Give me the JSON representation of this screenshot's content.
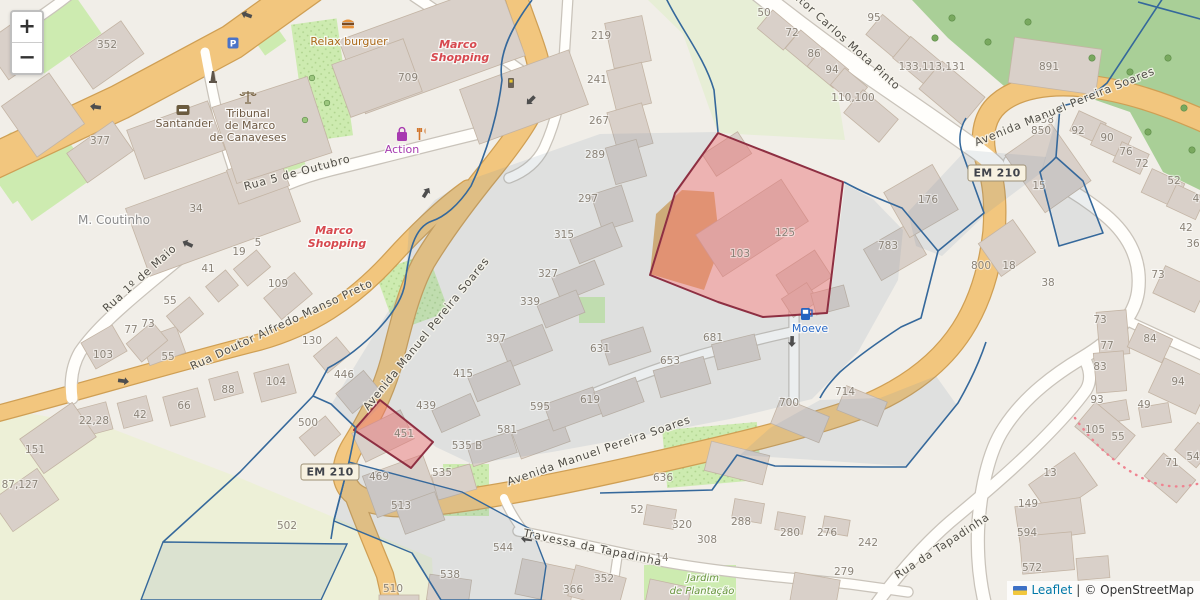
{
  "map_ui": {
    "zoom_control": {
      "zoom_in": "+",
      "zoom_out": "−"
    },
    "attribution": {
      "leaflet_link": "Leaflet",
      "separator": "|",
      "osm_credit": "© OpenStreetMap"
    },
    "road_ref_badges": [
      {
        "text": "EM 210",
        "x": 330,
        "y": 472
      },
      {
        "text": "EM 210",
        "x": 997,
        "y": 173
      }
    ]
  },
  "colors": {
    "boundary_line": "#35689b",
    "highlight_fill": "rgba(232,112,117,0.47)",
    "highlight_stroke": "#8e2f42",
    "road_major": "#f2c67e",
    "dotted_path": "#ef8390",
    "poi_mall": "#d7494f",
    "poi_shop": "#a73ab0",
    "poi_food": "#ab6a1a",
    "poi_fuel": "#2a6bc8",
    "poi_garden": "#68953d",
    "poi_amenity": "#6e5a44"
  },
  "street_labels": [
    {
      "text": "Rua 5 de Outubro",
      "x": 298,
      "y": 176,
      "rotation": -15
    },
    {
      "text": "Rua 1º de Maio",
      "x": 142,
      "y": 281,
      "rotation": -42
    },
    {
      "text": "Rua Doutor Alfredo Manso Preto",
      "x": 283,
      "y": 328,
      "rotation": -25
    },
    {
      "text": "Avenida Manuel Pereira Soares",
      "x": 429,
      "y": 336,
      "rotation": -51
    },
    {
      "text": "Avenida Manuel Pereira Soares",
      "x": 600,
      "y": 454,
      "rotation": -19
    },
    {
      "text": "Avenida Manuel Pereira Soares",
      "x": 1066,
      "y": 110,
      "rotation": -22
    },
    {
      "text": "Doutor Carlos Mota Pinto",
      "x": 838,
      "y": 38,
      "rotation": 42
    },
    {
      "text": "Travessa da Tapadinha",
      "x": 592,
      "y": 551,
      "rotation": 12
    },
    {
      "text": "Rua da Tapadinha",
      "x": 944,
      "y": 549,
      "rotation": -33
    }
  ],
  "poi_labels": [
    {
      "text": "Relax burguer",
      "x": 349,
      "y": 45,
      "kind": "poi-food"
    },
    {
      "text": "Marco",
      "x": 458,
      "y": 48,
      "kind": "poi-mall"
    },
    {
      "text": "Shopping",
      "x": 460,
      "y": 61,
      "kind": "poi-mall"
    },
    {
      "text": "Marco",
      "x": 334,
      "y": 234,
      "kind": "poi-mall"
    },
    {
      "text": "Shopping",
      "x": 337,
      "y": 247,
      "kind": "poi-mall"
    },
    {
      "text": "Action",
      "x": 402,
      "y": 153,
      "kind": "poi-shop"
    },
    {
      "text": "Santander",
      "x": 184,
      "y": 127,
      "kind": "poi-amenity"
    },
    {
      "text": "Tribunal",
      "x": 248,
      "y": 117,
      "kind": "poi-amenity"
    },
    {
      "text": "de Marco",
      "x": 250,
      "y": 129,
      "kind": "poi-amenity"
    },
    {
      "text": "de Canaveses",
      "x": 248,
      "y": 141,
      "kind": "poi-amenity"
    },
    {
      "text": "M. Coutinho",
      "x": 114,
      "y": 224,
      "kind": "poi-gray"
    },
    {
      "text": "Moeve",
      "x": 810,
      "y": 332,
      "kind": "poi-fuel"
    },
    {
      "text": "Jardim",
      "x": 703,
      "y": 581,
      "kind": "poi-garden"
    },
    {
      "text": "de Plantação",
      "x": 702,
      "y": 594,
      "kind": "poi-garden"
    }
  ],
  "house_numbers": [
    [
      107,
      48,
      "352"
    ],
    [
      100,
      144,
      "377"
    ],
    [
      408,
      81,
      "709"
    ],
    [
      196,
      212,
      "34"
    ],
    [
      258,
      246,
      "5"
    ],
    [
      239,
      255,
      "19"
    ],
    [
      208,
      272,
      "41"
    ],
    [
      278,
      287,
      "109"
    ],
    [
      170,
      304,
      "55"
    ],
    [
      148,
      327,
      "73"
    ],
    [
      131,
      333,
      "77"
    ],
    [
      312,
      344,
      "130"
    ],
    [
      103,
      358,
      "103"
    ],
    [
      168,
      360,
      "55"
    ],
    [
      344,
      378,
      "446"
    ],
    [
      276,
      385,
      "104"
    ],
    [
      228,
      393,
      "88"
    ],
    [
      184,
      409,
      "66"
    ],
    [
      140,
      418,
      "42"
    ],
    [
      94,
      424,
      "22,28"
    ],
    [
      35,
      453,
      "151"
    ],
    [
      20,
      488,
      "87,127"
    ],
    [
      308,
      426,
      "500"
    ],
    [
      287,
      529,
      "502"
    ],
    [
      393,
      592,
      "510"
    ],
    [
      601,
      39,
      "219"
    ],
    [
      597,
      83,
      "241"
    ],
    [
      599,
      124,
      "267"
    ],
    [
      595,
      158,
      "289"
    ],
    [
      588,
      202,
      "297"
    ],
    [
      564,
      238,
      "315"
    ],
    [
      548,
      277,
      "327"
    ],
    [
      530,
      305,
      "339"
    ],
    [
      496,
      342,
      "397"
    ],
    [
      463,
      377,
      "415"
    ],
    [
      426,
      409,
      "439"
    ],
    [
      404,
      437,
      "451"
    ],
    [
      379,
      480,
      "469"
    ],
    [
      401,
      509,
      "513"
    ],
    [
      442,
      476,
      "535"
    ],
    [
      467,
      449,
      "535 B"
    ],
    [
      507,
      433,
      "581"
    ],
    [
      540,
      410,
      "595"
    ],
    [
      590,
      403,
      "619"
    ],
    [
      503,
      551,
      "544"
    ],
    [
      450,
      578,
      "538"
    ],
    [
      600,
      352,
      "631"
    ],
    [
      670,
      364,
      "653"
    ],
    [
      713,
      341,
      "681"
    ],
    [
      789,
      406,
      "700"
    ],
    [
      845,
      395,
      "714"
    ],
    [
      663,
      481,
      "636"
    ],
    [
      637,
      513,
      "52"
    ],
    [
      682,
      528,
      "320"
    ],
    [
      707,
      543,
      "308"
    ],
    [
      741,
      525,
      "288"
    ],
    [
      790,
      536,
      "280"
    ],
    [
      827,
      536,
      "276"
    ],
    [
      868,
      546,
      "242"
    ],
    [
      662,
      561,
      "14"
    ],
    [
      844,
      575,
      "279"
    ],
    [
      604,
      582,
      "352"
    ],
    [
      573,
      593,
      "366"
    ],
    [
      740,
      257,
      "103"
    ],
    [
      785,
      236,
      "125"
    ],
    [
      888,
      249,
      "783"
    ],
    [
      928,
      203,
      "176"
    ],
    [
      764,
      16,
      "50"
    ],
    [
      792,
      36,
      "72"
    ],
    [
      814,
      57,
      "86"
    ],
    [
      832,
      73,
      "94"
    ],
    [
      874,
      21,
      "95"
    ],
    [
      853,
      101,
      "110,100"
    ],
    [
      932,
      70,
      "133,113,131"
    ],
    [
      1049,
      70,
      "891"
    ],
    [
      1044,
      123,
      "858"
    ],
    [
      1041,
      134,
      "850"
    ],
    [
      1078,
      134,
      "92"
    ],
    [
      1107,
      141,
      "90"
    ],
    [
      1126,
      155,
      "76"
    ],
    [
      1142,
      167,
      "72"
    ],
    [
      1174,
      184,
      "52"
    ],
    [
      1196,
      202,
      "4"
    ],
    [
      1186,
      231,
      "42"
    ],
    [
      1193,
      247,
      "36"
    ],
    [
      1039,
      189,
      "15"
    ],
    [
      981,
      269,
      "800"
    ],
    [
      1009,
      269,
      "18"
    ],
    [
      1048,
      286,
      "38"
    ],
    [
      1158,
      278,
      "73"
    ],
    [
      1100,
      323,
      "73"
    ],
    [
      1107,
      349,
      "77"
    ],
    [
      1100,
      370,
      "83"
    ],
    [
      1150,
      342,
      "84"
    ],
    [
      1178,
      385,
      "94"
    ],
    [
      1097,
      403,
      "93"
    ],
    [
      1144,
      408,
      "49"
    ],
    [
      1095,
      433,
      "105"
    ],
    [
      1118,
      440,
      "55"
    ],
    [
      1172,
      466,
      "71"
    ],
    [
      1193,
      460,
      "54"
    ],
    [
      1050,
      476,
      "13"
    ],
    [
      1028,
      507,
      "149"
    ],
    [
      1027,
      536,
      "594"
    ],
    [
      1032,
      571,
      "572"
    ]
  ]
}
